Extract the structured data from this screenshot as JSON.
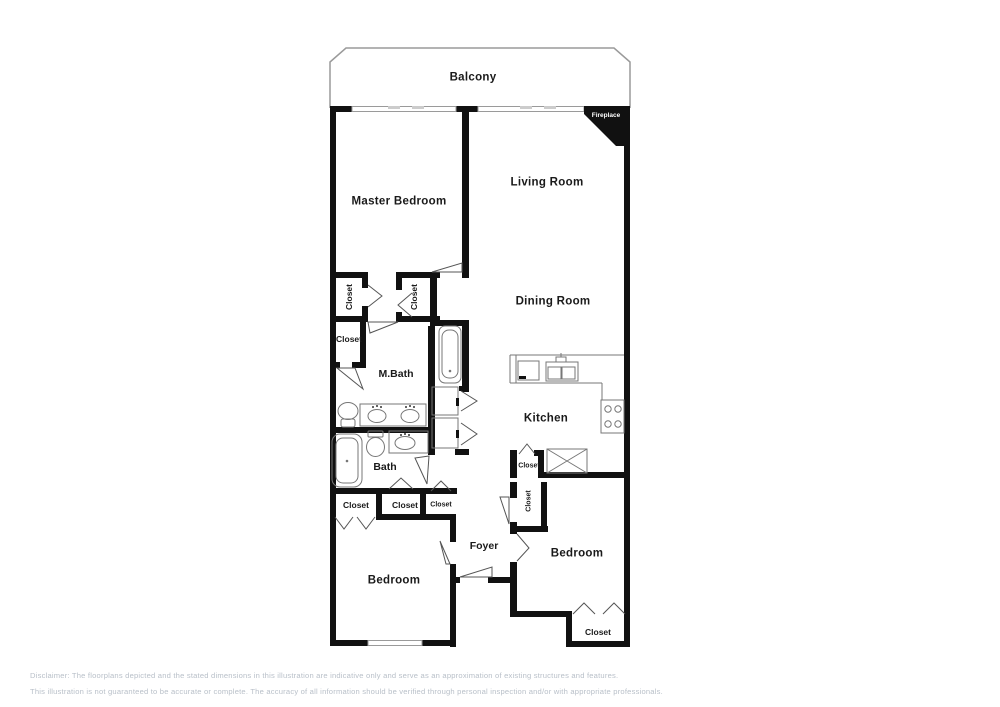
{
  "labels": {
    "balcony": "Balcony",
    "master_bedroom": "Master Bedroom",
    "living_room": "Living Room",
    "dining_room": "Dining Room",
    "kitchen": "Kitchen",
    "m_bath": "M.Bath",
    "bath": "Bath",
    "foyer": "Foyer",
    "bedroom": "Bedroom",
    "closet": "Closet",
    "fireplace": "Fireplace"
  },
  "disclaimer": {
    "line1": "Disclaimer: The floorplans depicted and the stated dimensions in this illustration are indicative only and serve as an approximation of existing structures and features.",
    "line2": "This illustration is not guaranteed to be accurate or complete. The accuracy of all information should be verified through personal inspection and/or with appropriate professionals."
  },
  "colors": {
    "wall": "#111111",
    "fixture_line": "#777777",
    "balcony_line": "#9a9a9a",
    "disclaimer_text": "#b9c0c9"
  }
}
